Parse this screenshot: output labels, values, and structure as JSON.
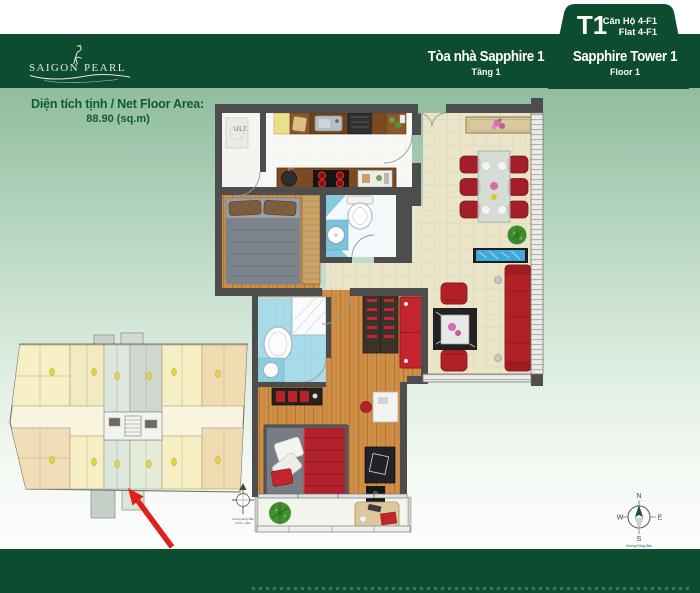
{
  "header": {
    "brand": {
      "name_left": "SAIGON",
      "name_right": "PEARL"
    },
    "tab": {
      "tower_code": "T1",
      "unit_vi": "Căn Hộ 4-F1",
      "unit_en": "Flat 4-F1"
    },
    "tower_vi": {
      "name": "Tòa nhà Sapphire 1",
      "floor": "Tầng 1"
    },
    "tower_en": {
      "name": "Sapphire Tower 1",
      "floor": "Floor 1"
    }
  },
  "area_info": {
    "label": "Diện tích tịnh / Net Floor Area:",
    "value": "88.90 (sq.m)"
  },
  "plan": {
    "utility_label": "ULT."
  },
  "compass": {
    "north": "N",
    "east": "E",
    "south": "S",
    "west": "W",
    "caption_line1": "Hướng Đông Bắc",
    "caption_line2": "North - East"
  },
  "colors": {
    "brand_green": "#0e4c32",
    "band_green": "#7db593",
    "arrow_red": "#e0201c",
    "sofa_red": "#b02025",
    "wood": "#cd8d45",
    "tile": "#eae5c9"
  }
}
